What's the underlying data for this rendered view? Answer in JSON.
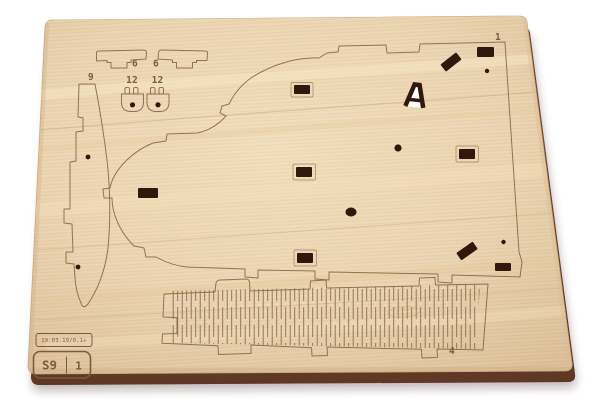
{
  "background_color": "#ffffff",
  "board": {
    "face_color": "#ebd4b1",
    "edge_color": "#6a4030",
    "cut_line_color": "#8d6b4e",
    "engraving_color": "#7b5a3f",
    "slot_fill_color": "#31180d",
    "hole_backing_color": "#ffffff"
  },
  "piece_labels": {
    "piano_panel": "1",
    "hinge_strip": "4",
    "bracket_left": "6",
    "bracket_right": "6",
    "side_rib": "9",
    "pedal_left": "12",
    "pedal_right": "12"
  },
  "stamp": {
    "info_line": "19.03.19/0,1✳",
    "sheet_code": "S9",
    "sheet_number": "1"
  }
}
